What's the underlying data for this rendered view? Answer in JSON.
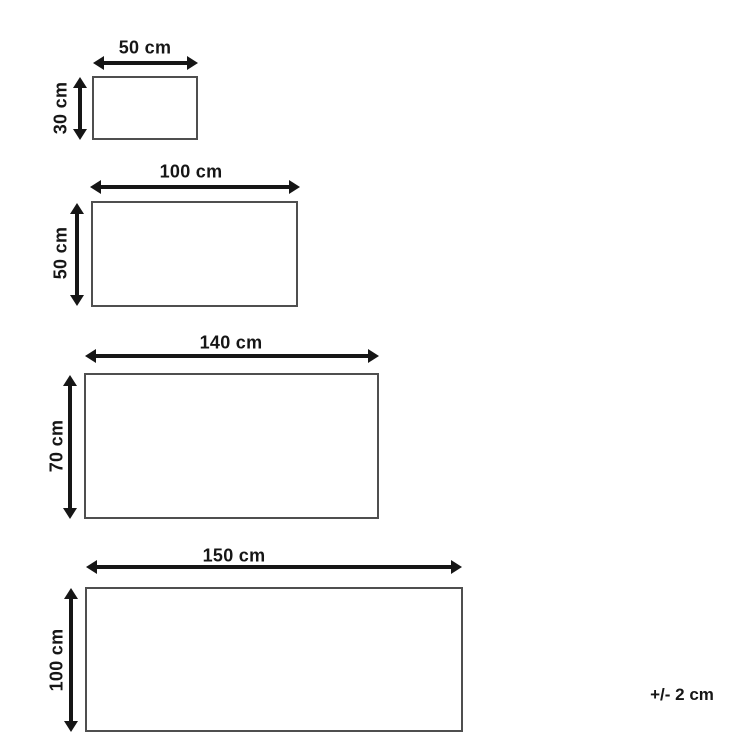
{
  "sizes": [
    {
      "width_cm": 50,
      "height_cm": 30,
      "width_label": "50 cm",
      "height_label": "30 cm"
    },
    {
      "width_cm": 100,
      "height_cm": 50,
      "width_label": "100 cm",
      "height_label": "50 cm"
    },
    {
      "width_cm": 140,
      "height_cm": 70,
      "width_label": "140 cm",
      "height_label": "70 cm"
    },
    {
      "width_cm": 150,
      "height_cm": 100,
      "width_label": "150 cm",
      "height_label": "100 cm"
    }
  ],
  "tolerance_note": "+/- 2 cm",
  "colors": {
    "line": "#161616",
    "rect_border": "#4f4f4f",
    "background": "#ffffff"
  }
}
